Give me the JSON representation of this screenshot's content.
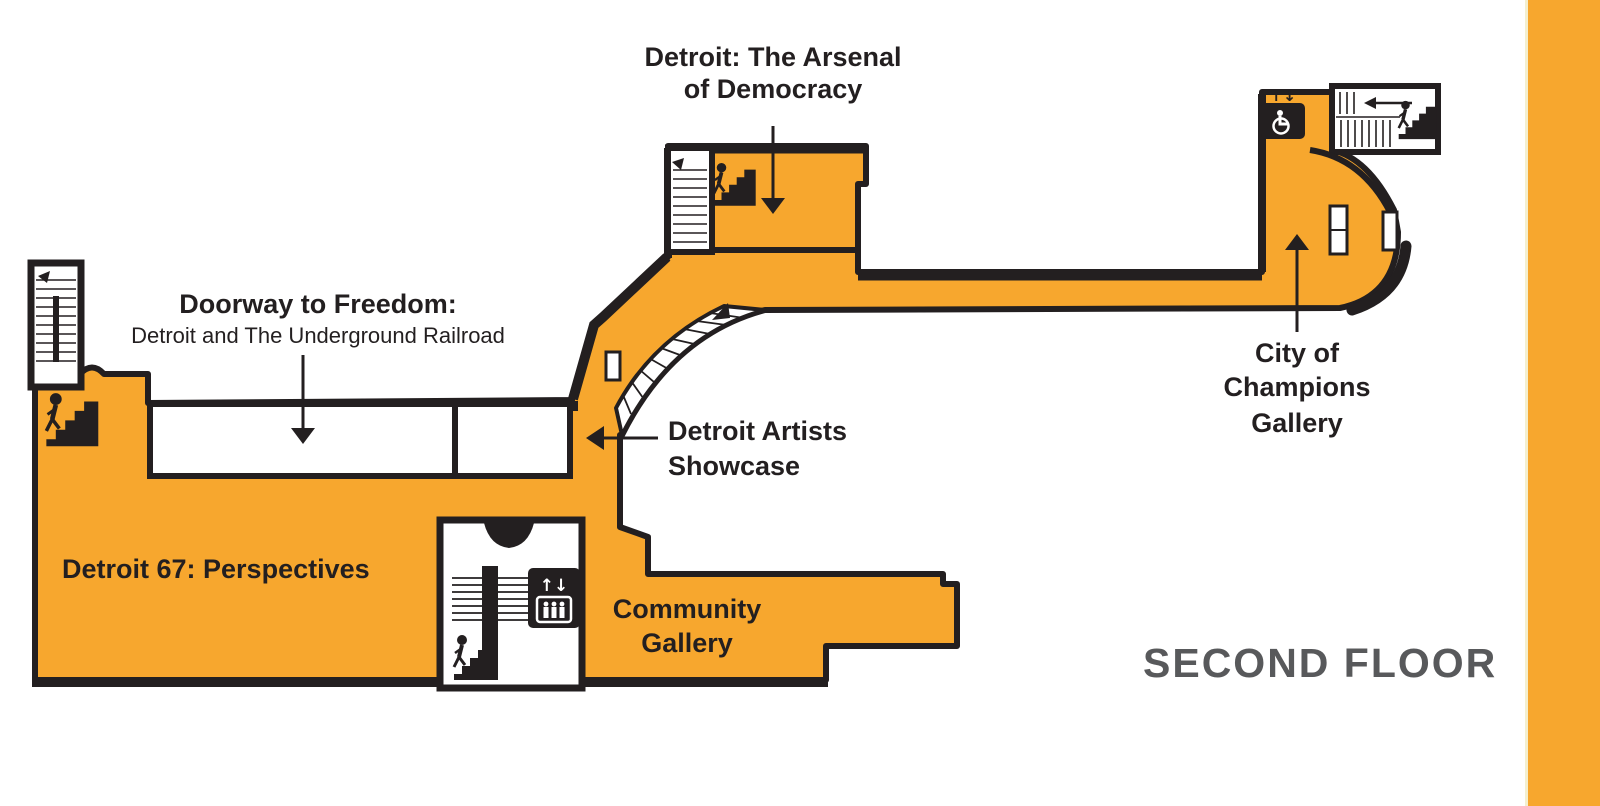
{
  "colors": {
    "room_fill": "#F7A72E",
    "wall": "#231F20",
    "label_text": "#231F20",
    "floor_text": "#58595B",
    "accent_bar": "#F7A72E",
    "background": "#FFFFFF"
  },
  "labels": {
    "arsenal_line1": "Detroit: The Arsenal",
    "arsenal_line2": "of Democracy",
    "doorway_line1": "Doorway to Freedom:",
    "doorway_line2": "Detroit and The Underground Railroad",
    "artists_line1": "Detroit Artists",
    "artists_line2": "Showcase",
    "city_line1": "City of",
    "city_line2": "Champions",
    "city_line3": "Gallery",
    "detroit67": "Detroit 67: Perspectives",
    "community_line1": "Community",
    "community_line2": "Gallery",
    "floor": "SECOND FLOOR"
  },
  "icons": {
    "stairs": "stairs-person-icon",
    "accessible_elevator": "elevator-accessible-icon",
    "elevator": "elevator-people-icon",
    "staircase_hatch": "staircase-treads",
    "direction_arrows": "arrow-pointer"
  }
}
